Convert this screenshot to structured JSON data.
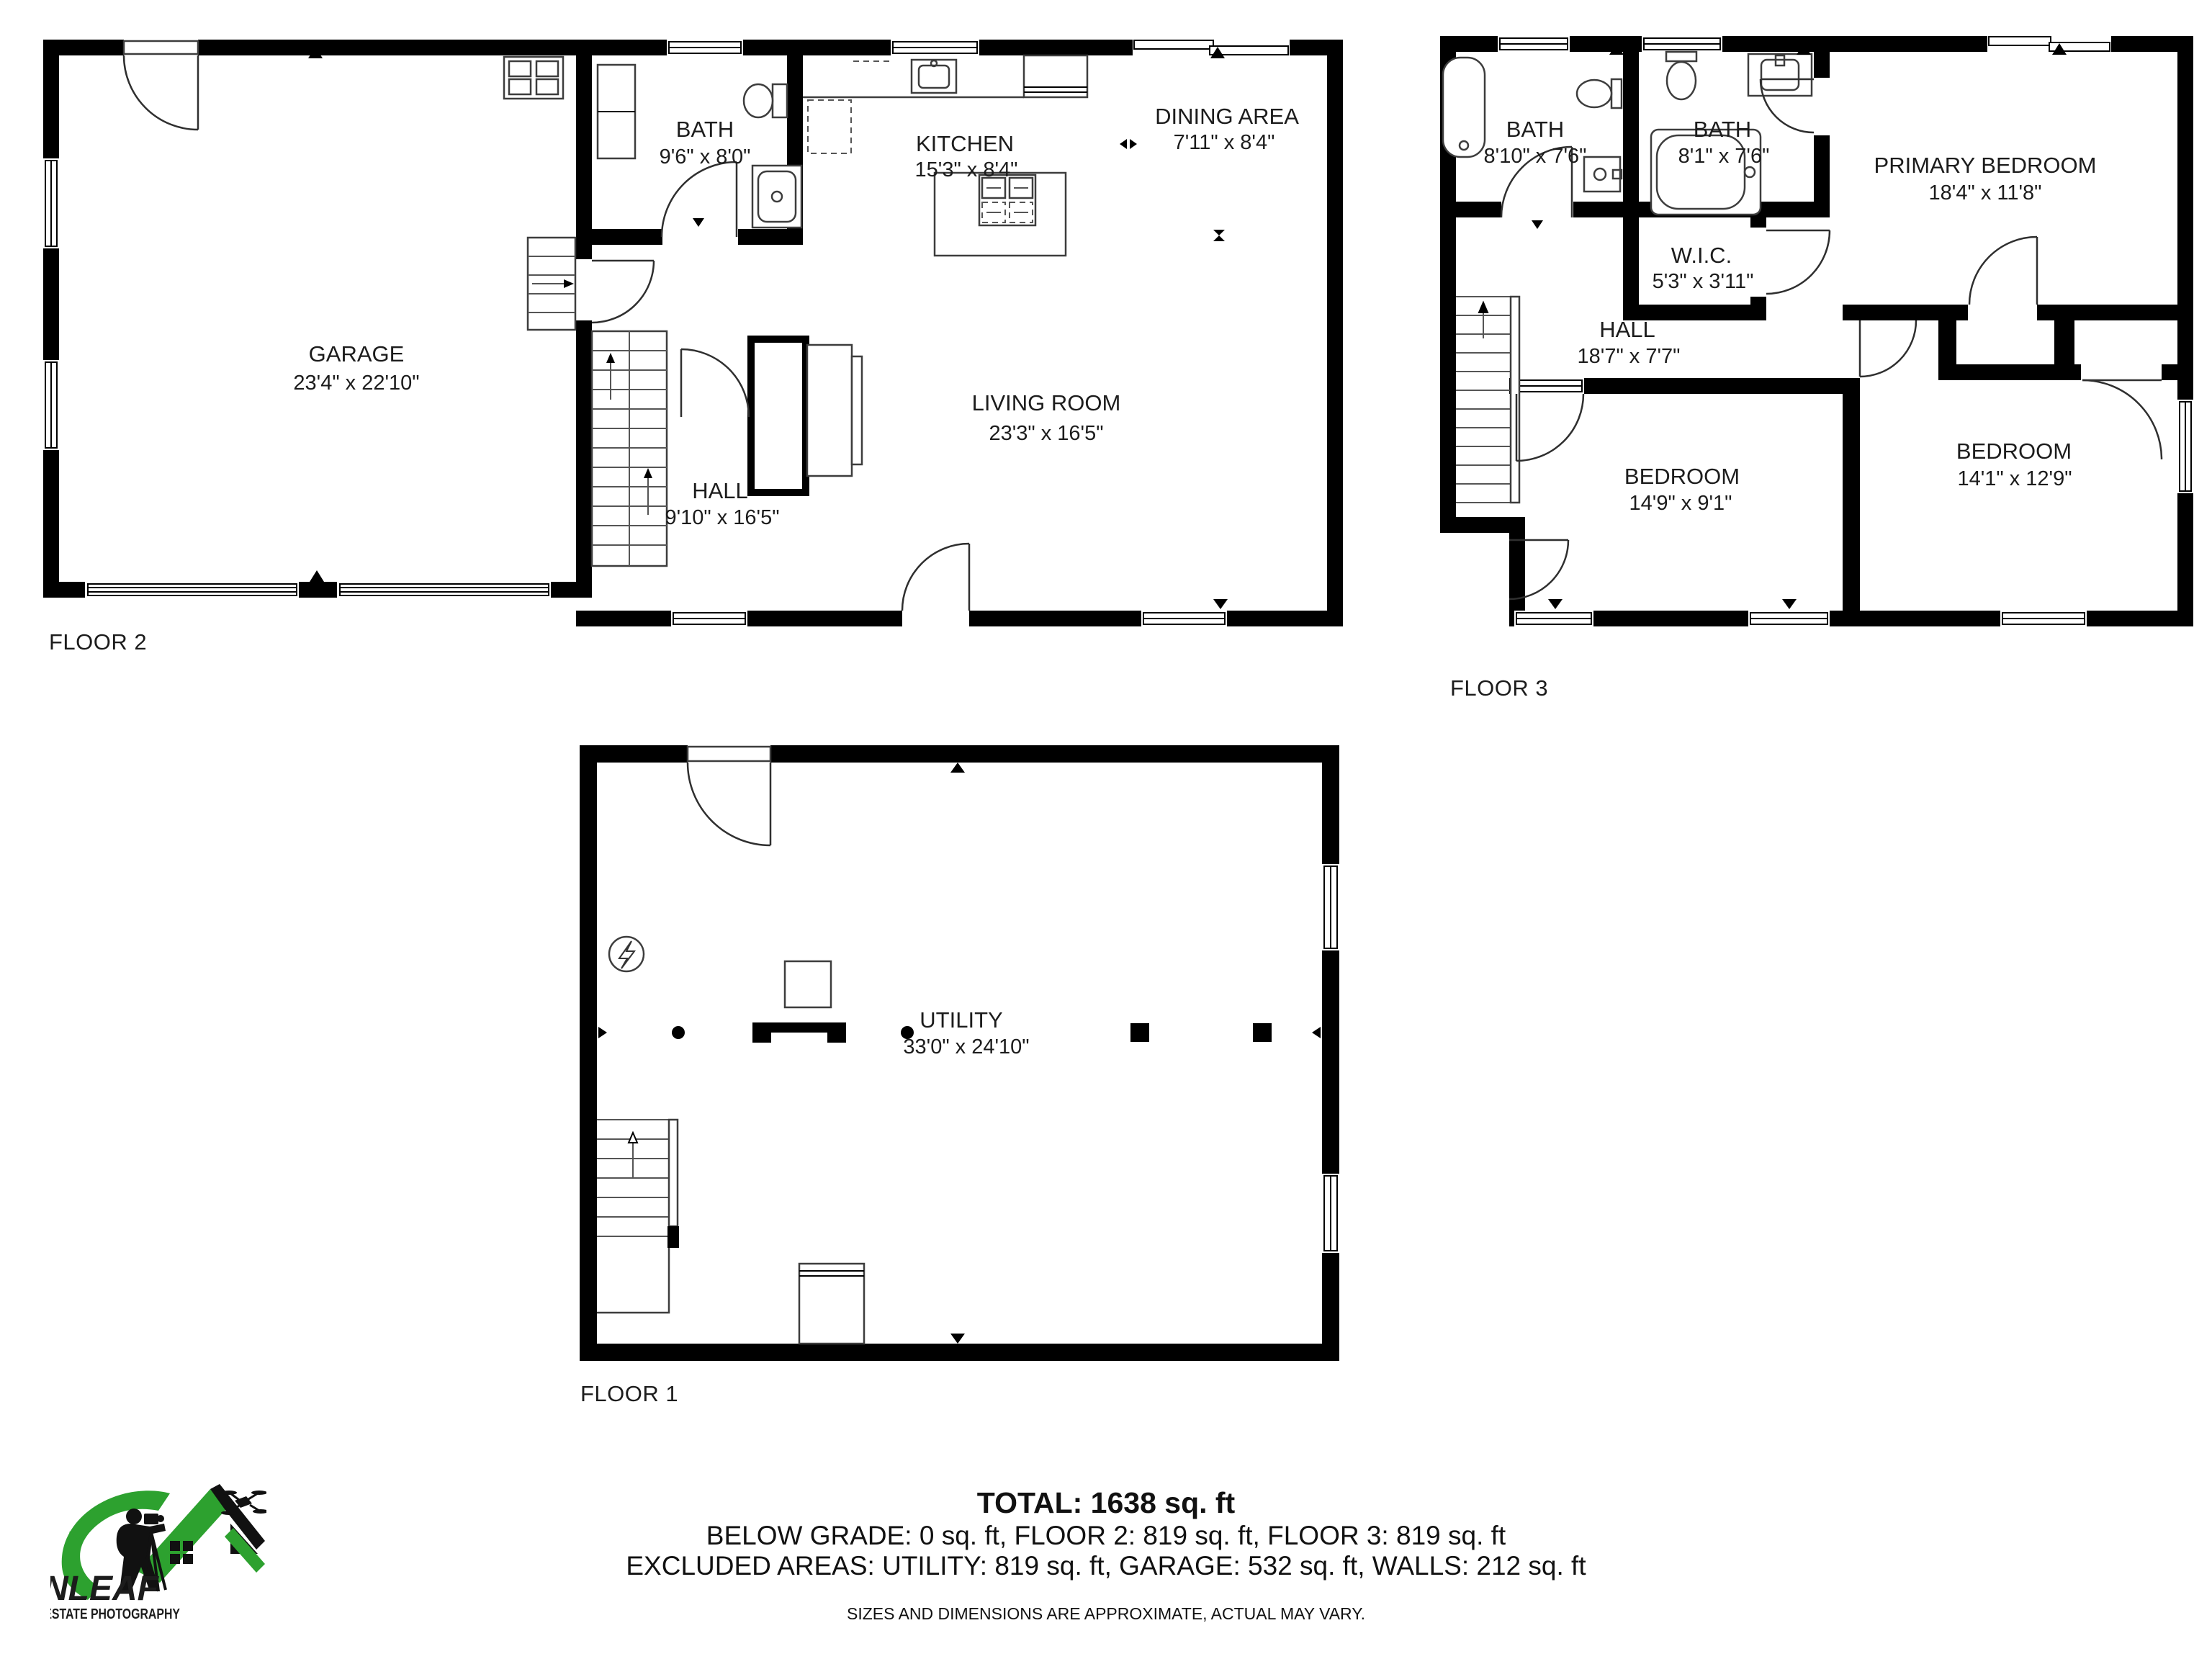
{
  "floors": [
    {
      "id": "floor2",
      "label": "FLOOR 2",
      "rooms": [
        {
          "name": "GARAGE",
          "dims": "23'4\" x 22'10\""
        },
        {
          "name": "BATH",
          "dims": "9'6\" x 8'0\""
        },
        {
          "name": "KITCHEN",
          "dims": "15'3\" x 8'4\""
        },
        {
          "name": "DINING AREA",
          "dims": "7'11\" x 8'4\""
        },
        {
          "name": "LIVING ROOM",
          "dims": "23'3\" x 16'5\""
        },
        {
          "name": "HALL",
          "dims": "9'10\" x 16'5\""
        }
      ]
    },
    {
      "id": "floor3",
      "label": "FLOOR 3",
      "rooms": [
        {
          "name": "BATH",
          "dims": "8'10\" x 7'6\""
        },
        {
          "name": "BATH",
          "dims": "8'1\" x 7'6\""
        },
        {
          "name": "PRIMARY BEDROOM",
          "dims": "18'4\" x 11'8\""
        },
        {
          "name": "W.I.C.",
          "dims": "5'3\" x 3'11\""
        },
        {
          "name": "HALL",
          "dims": "18'7\" x 7'7\""
        },
        {
          "name": "BEDROOM",
          "dims": "14'9\" x 9'1\""
        },
        {
          "name": "BEDROOM",
          "dims": "14'1\" x 12'9\""
        }
      ]
    },
    {
      "id": "floor1",
      "label": "FLOOR 1",
      "rooms": [
        {
          "name": "UTILITY",
          "dims": "33'0\" x 24'10\""
        }
      ]
    }
  ],
  "summary": {
    "total": "TOTAL: 1638 sq. ft",
    "breakdown": "BELOW GRADE: 0 sq. ft, FLOOR 2: 819 sq. ft, FLOOR 3: 819 sq. ft",
    "excluded": "EXCLUDED AREAS: UTILITY: 819 sq. ft, GARAGE: 532 sq. ft, WALLS: 212 sq. ft",
    "disclaimer": "SIZES AND DIMENSIONS ARE APPROXIMATE, ACTUAL MAY VARY."
  },
  "logo": {
    "brand": "GREENLEAF",
    "tagline": "REAL ESTATE PHOTOGRAPHY",
    "green": "#2da12f",
    "black": "#111111"
  }
}
